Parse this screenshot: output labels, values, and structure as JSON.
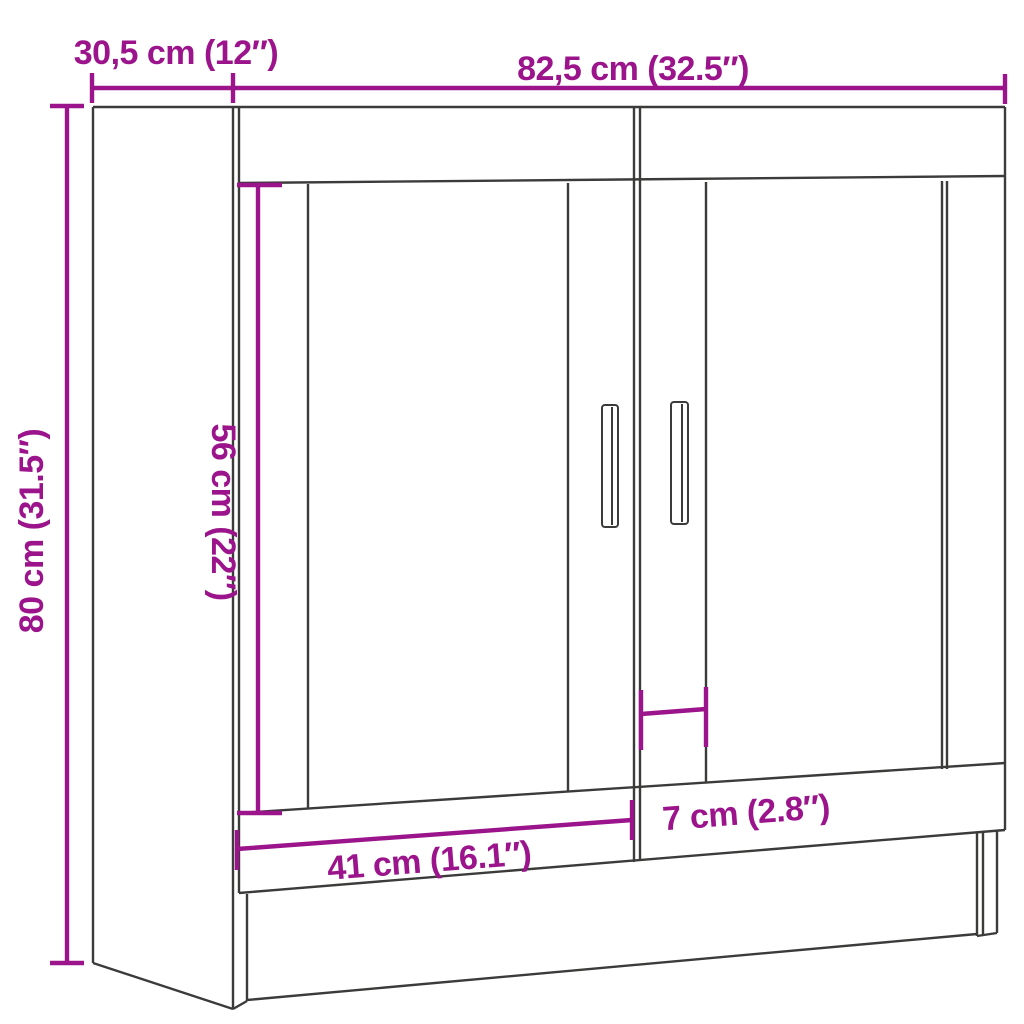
{
  "title": "Wall cabinet dimension diagram",
  "colors": {
    "background": "#ffffff",
    "outline": "#3b3b3a",
    "dimension": "#9b148b"
  },
  "dimensions": {
    "depth_top_left": {
      "label": "30,5 cm (12″)"
    },
    "width_top": {
      "label": "82,5 cm (32.5″)"
    },
    "height_left": {
      "label": "80 cm (31.5″)"
    },
    "glass_height": {
      "label": "56 cm (22″)"
    },
    "door_width": {
      "label": "41 cm (16.1″)"
    },
    "frame_width": {
      "label": "7 cm (2.8″)"
    }
  }
}
